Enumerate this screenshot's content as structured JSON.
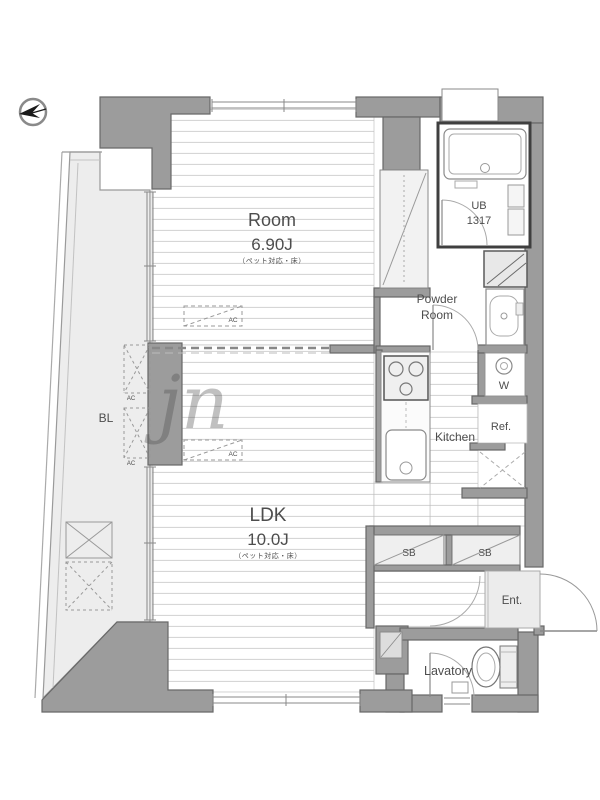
{
  "labels": {
    "room_name": "Room",
    "room_size": "6.90J",
    "room_note": "（ペット対応・床）",
    "ldk_name": "LDK",
    "ldk_size": "10.0J",
    "ldk_note": "（ペット対応・床）",
    "ub_line1": "UB",
    "ub_line2": "1317",
    "powder_line1": "Powder",
    "powder_line2": "Room",
    "kitchen": "Kitchen",
    "washer": "W",
    "refrigerator": "Ref.",
    "balcony": "BL",
    "shoe_box_1": "SB",
    "shoe_box_2": "SB",
    "entrance": "Ent.",
    "lavatory": "Lavatory",
    "ac_room": "AC",
    "ac_ldk": "AC",
    "ac_balcony_upper": "AC",
    "ac_balcony_lower": "AC",
    "watermark": "jn"
  },
  "colors": {
    "wall_fill": "#9c9c9c",
    "wall_outline": "#686868",
    "floor_line": "#d6d6d6",
    "balcony_fill": "#ededed",
    "closet_fill": "#f2f2f2",
    "label_text": "#4d4d4d"
  }
}
